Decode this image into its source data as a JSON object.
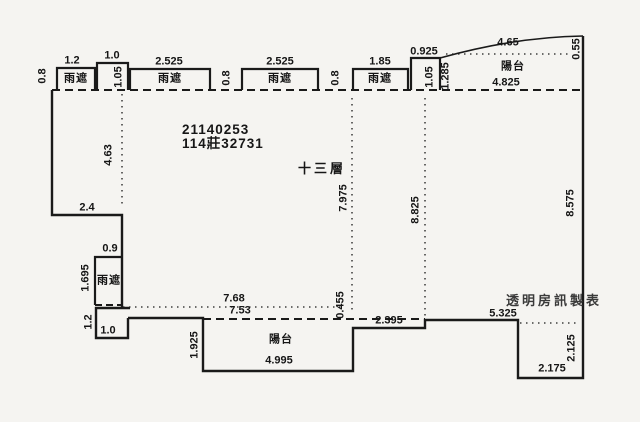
{
  "floorplan": {
    "background_color": "#f5f4f1",
    "line_color": "#1a1a1a",
    "registration_number": "21140253",
    "serial_number": "114莊32731",
    "floor_label": "十三層",
    "watermark": "透明房訊製表",
    "legend": {
      "rain_shield": "雨遮",
      "balcony": "陽台"
    },
    "labels": [
      {
        "text": "0.8",
        "x": 43,
        "y": 76,
        "rot": true,
        "kind": "dim"
      },
      {
        "text": "1.2",
        "x": 72,
        "y": 61,
        "rot": false,
        "kind": "dim"
      },
      {
        "text": "雨遮",
        "x": 76,
        "y": 79,
        "rot": false,
        "kind": "room"
      },
      {
        "text": "1.0",
        "x": 112,
        "y": 56,
        "rot": false,
        "kind": "dim"
      },
      {
        "text": "1.05",
        "x": 119,
        "y": 77,
        "rot": true,
        "kind": "dim"
      },
      {
        "text": "2.525",
        "x": 169,
        "y": 62,
        "rot": false,
        "kind": "dim"
      },
      {
        "text": "雨遮",
        "x": 170,
        "y": 79,
        "rot": false,
        "kind": "room"
      },
      {
        "text": "0.8",
        "x": 227,
        "y": 78,
        "rot": true,
        "kind": "dim"
      },
      {
        "text": "2.525",
        "x": 280,
        "y": 62,
        "rot": false,
        "kind": "dim"
      },
      {
        "text": "雨遮",
        "x": 280,
        "y": 79,
        "rot": false,
        "kind": "room"
      },
      {
        "text": "0.8",
        "x": 336,
        "y": 78,
        "rot": true,
        "kind": "dim"
      },
      {
        "text": "1.85",
        "x": 380,
        "y": 62,
        "rot": false,
        "kind": "dim"
      },
      {
        "text": "雨遮",
        "x": 380,
        "y": 79,
        "rot": false,
        "kind": "room"
      },
      {
        "text": "0.925",
        "x": 424,
        "y": 52,
        "rot": false,
        "kind": "dim"
      },
      {
        "text": "1.05",
        "x": 430,
        "y": 77,
        "rot": true,
        "kind": "dim"
      },
      {
        "text": "1.285",
        "x": 446,
        "y": 76,
        "rot": true,
        "kind": "dim"
      },
      {
        "text": "4.65",
        "x": 508,
        "y": 43,
        "rot": false,
        "kind": "dim"
      },
      {
        "text": "0.55",
        "x": 577,
        "y": 49,
        "rot": true,
        "kind": "dim"
      },
      {
        "text": "陽台",
        "x": 513,
        "y": 67,
        "rot": false,
        "kind": "room"
      },
      {
        "text": "4.825",
        "x": 506,
        "y": 83,
        "rot": false,
        "kind": "dim"
      },
      {
        "text": "4.63",
        "x": 109,
        "y": 155,
        "rot": true,
        "kind": "dim"
      },
      {
        "text": "7.975",
        "x": 344,
        "y": 198,
        "rot": true,
        "kind": "dim"
      },
      {
        "text": "8.825",
        "x": 416,
        "y": 210,
        "rot": true,
        "kind": "dim"
      },
      {
        "text": "8.575",
        "x": 571,
        "y": 203,
        "rot": true,
        "kind": "dim"
      },
      {
        "text": "2.4",
        "x": 87,
        "y": 208,
        "rot": false,
        "kind": "dim"
      },
      {
        "text": "0.9",
        "x": 110,
        "y": 249,
        "rot": false,
        "kind": "dim"
      },
      {
        "text": "1.695",
        "x": 86,
        "y": 278,
        "rot": true,
        "kind": "dim"
      },
      {
        "text": "雨遮",
        "x": 109,
        "y": 281,
        "rot": false,
        "kind": "room"
      },
      {
        "text": "7.68",
        "x": 234,
        "y": 299,
        "rot": false,
        "kind": "dim"
      },
      {
        "text": "7.53",
        "x": 240,
        "y": 311,
        "rot": false,
        "kind": "dim"
      },
      {
        "text": "1.2",
        "x": 89,
        "y": 322,
        "rot": true,
        "kind": "dim"
      },
      {
        "text": "1.0",
        "x": 108,
        "y": 331,
        "rot": false,
        "kind": "dim"
      },
      {
        "text": "1.925",
        "x": 195,
        "y": 345,
        "rot": true,
        "kind": "dim"
      },
      {
        "text": "陽台",
        "x": 281,
        "y": 340,
        "rot": false,
        "kind": "room"
      },
      {
        "text": "4.995",
        "x": 279,
        "y": 361,
        "rot": false,
        "kind": "dim"
      },
      {
        "text": "0.455",
        "x": 341,
        "y": 305,
        "rot": true,
        "kind": "dim"
      },
      {
        "text": "2.395",
        "x": 389,
        "y": 321,
        "rot": false,
        "kind": "dim"
      },
      {
        "text": "5.325",
        "x": 503,
        "y": 314,
        "rot": false,
        "kind": "dim"
      },
      {
        "text": "2.125",
        "x": 572,
        "y": 348,
        "rot": true,
        "kind": "dim"
      },
      {
        "text": "2.175",
        "x": 552,
        "y": 369,
        "rot": false,
        "kind": "dim"
      }
    ]
  }
}
